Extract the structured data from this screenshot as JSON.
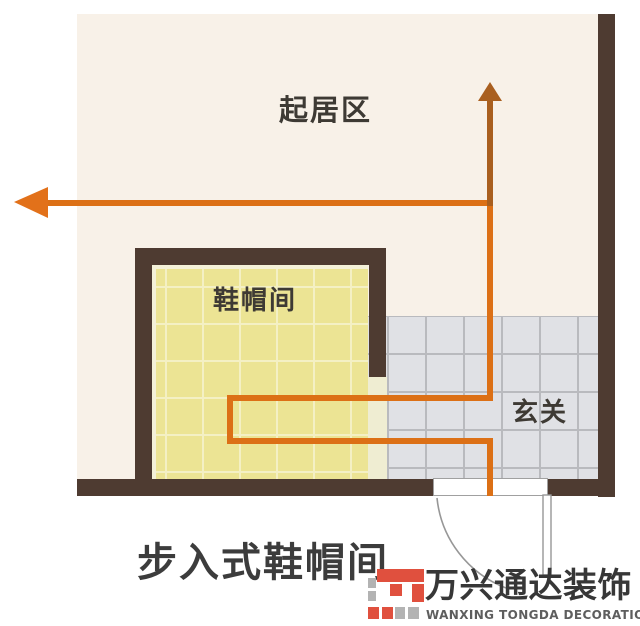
{
  "caption": "步入式鞋帽间",
  "plan": {
    "labels": {
      "living_area": "起居区",
      "shoe_room": "鞋帽间",
      "hallway": "玄关"
    },
    "colors": {
      "wall": "#4e3b31",
      "floor_cream": "#f8f1e8",
      "tile_yellow": "#ece494",
      "tile_gray": "#e0e1e5",
      "path_orange": "#dc7016",
      "path_dark_orange": "#a95f1f"
    }
  },
  "watermark": {
    "brand_cn": "万兴通达装饰",
    "brand_en": "WANXING TONGDA DECORATION",
    "logo_red": "#e0503e",
    "logo_gray": "#b3b3b3"
  }
}
